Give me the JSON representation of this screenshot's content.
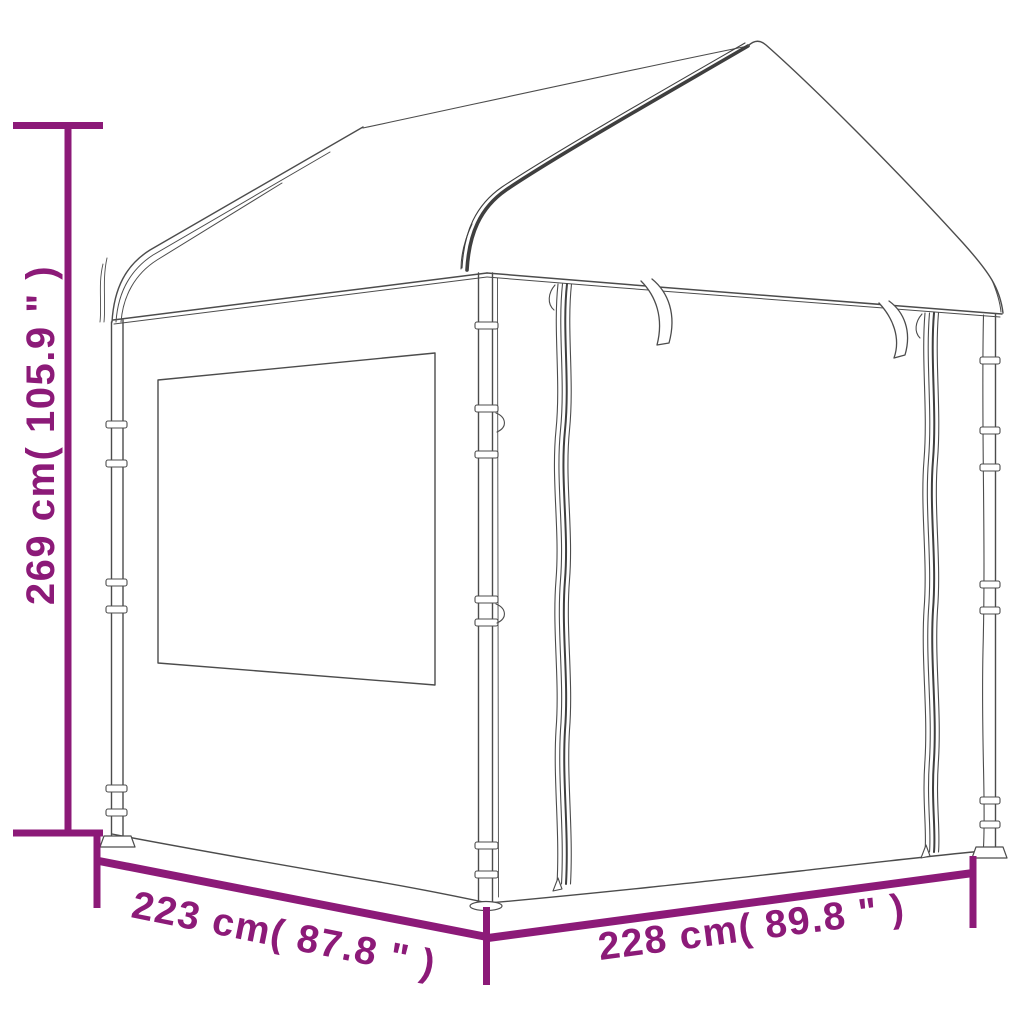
{
  "meta": {
    "image_type": "product dimension line drawing",
    "subject": "gazebo party tent with sidewalls, window and zipped panels",
    "background": "#ffffff"
  },
  "colors": {
    "dimension_accent": "#8C1A78",
    "drawing_line": "#4c4c4c",
    "seam_line": "#3f3f3f"
  },
  "dimensions": {
    "height": {
      "cm": "269",
      "inches": "105.9",
      "label": "269 cm( 105.9 \" )",
      "orientation": "vertical-left"
    },
    "side_depth": {
      "cm": "223",
      "inches": "87.8",
      "label": "223 cm( 87.8 \" )",
      "orientation": "diagonal-bottom-left"
    },
    "front_width": {
      "cm": "228",
      "inches": "89.8",
      "label": "228 cm( 89.8 \" )",
      "orientation": "diagonal-bottom-right"
    }
  }
}
